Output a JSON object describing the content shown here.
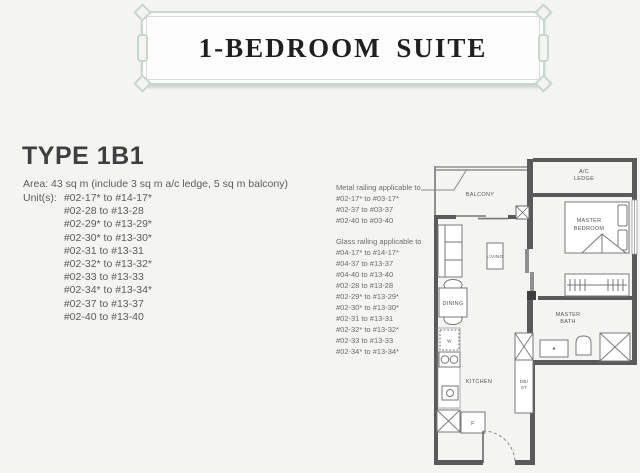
{
  "header": {
    "title": "1-BEDROOM SUITE",
    "frame_color": "#c9d6cc"
  },
  "type_section": {
    "title": "TYPE 1B1",
    "area_line": "Area: 43 sq m (include 3 sq m a/c ledge, 5 sq m balcony)",
    "units_label": "Unit(s):",
    "units": [
      "#02-17* to #14-17*",
      "#02-28 to #13-28",
      "#02-29* to #13-29*",
      "#02-30* to #13-30*",
      "#02-31 to #13-31",
      "#02-32* to #13-32*",
      "#02-33 to #13-33",
      "#02-34* to #13-34*",
      "#02-37 to #13-37",
      "#02-40 to #13-40"
    ]
  },
  "railing_notes": {
    "metal": {
      "title": "Metal railing applicable to",
      "units": [
        "#02-17* to #03-17*",
        "#02-37 to #03-37",
        "#02-40 to #03-40"
      ]
    },
    "glass": {
      "title": "Glass railing applicable to",
      "units": [
        "#04-17* to #14-17*",
        "#04-37 to #13-37",
        "#04-40 to #13-40",
        "#02-28 to #13-28",
        "#02-29* to #13-29*",
        "#02-30* to #13-30*",
        "#02-31 to #13-31",
        "#02-32* to #13-32*",
        "#02-33 to #13-33",
        "#02-34* to #13-34*"
      ]
    }
  },
  "floorplan": {
    "wall_color": "#5a5a5a",
    "labels": {
      "balcony": "BALCONY",
      "ac_ledge_line1": "A/C",
      "ac_ledge_line2": "LEDGE",
      "master_bedroom_line1": "MASTER",
      "master_bedroom_line2": "BEDROOM",
      "living": "LIVING",
      "dining": "DINING",
      "kitchen": "KITCHEN",
      "master_bath_line1": "MASTER",
      "master_bath_line2": "BATH",
      "db_st_line1": "DB/",
      "db_st_line2": "ST",
      "washer": "W",
      "fridge": "F"
    }
  }
}
